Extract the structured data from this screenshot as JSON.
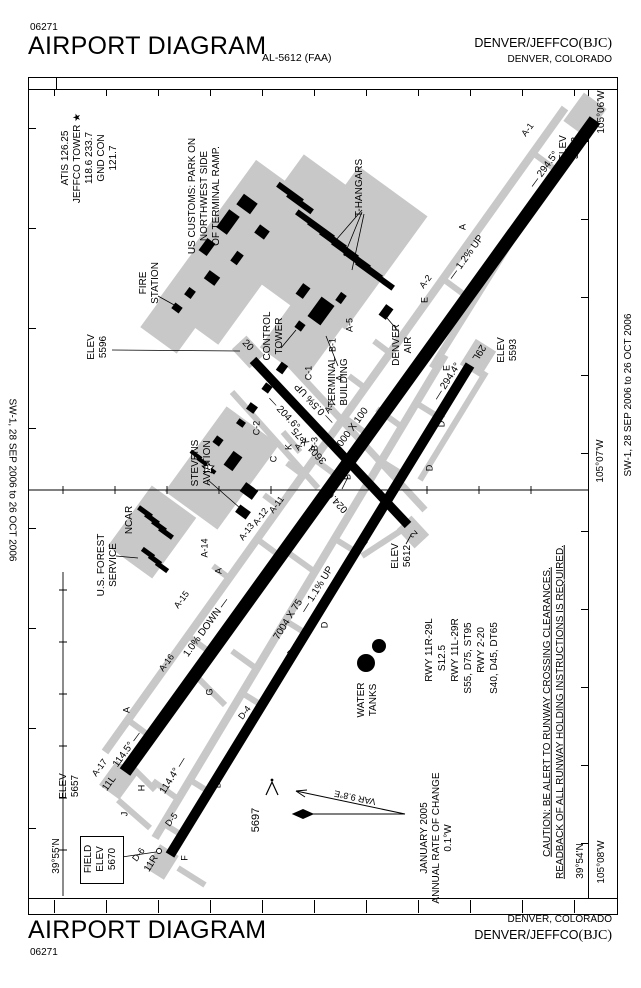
{
  "header": {
    "code": "06271",
    "title": "AIRPORT DIAGRAM",
    "al": "AL-5612 (FAA)",
    "name": "DENVER/JEFFCO",
    "icao": "(BJC)",
    "city": "DENVER, COLORADO"
  },
  "footer": {
    "title": "AIRPORT DIAGRAM",
    "code": "06271",
    "city": "DENVER, COLORADO",
    "name": "DENVER/JEFFCO",
    "icao": "(BJC)"
  },
  "edition": {
    "left": "SW-1, 28 SEP 2006 to 26 OCT 2006",
    "right": "SW-1, 28 SEP 2006 to 26 OCT 2006"
  },
  "grid": {
    "lon_top": "105°06'W",
    "lon_mid": "105°07'W",
    "lon_bot": "105°08'W",
    "lat_left": "39°55'N",
    "lat_right": "39°54'N"
  },
  "comm": [
    "ATIS 126.25",
    "JEFFCO TOWER ★",
    "118.6 233.7",
    "GND CON",
    "121.7"
  ],
  "notes": {
    "customs": [
      "US CUSTOMS: PARK ON",
      "NORTHWEST SIDE",
      "OF TERMINAL RAMP."
    ],
    "caution": [
      "CAUTION: BE ALERT TO RUNWAY CROSSING CLEARANCES.",
      "READBACK OF ALL RUNWAY HOLDING INSTRUCTIONS IS REQUIRED."
    ]
  },
  "variation": {
    "var": "VAR 9.8°E",
    "note": [
      "JANUARY 2005",
      "ANNUAL RATE OF CHANGE",
      "0.1°W"
    ]
  },
  "rwy_data": [
    "RWY 11R-29L",
    "S12.5",
    "RWY 11L-29R",
    "S55, D75, ST95",
    "RWY 2-20",
    "S40, D45, DT65"
  ],
  "field_elev": [
    "FIELD",
    "ELEV",
    "5670"
  ],
  "obstruction": "5697",
  "fac": {
    "thangars": "T-HANGARS",
    "fire": [
      "FIRE",
      "STATION"
    ],
    "tower": [
      "CONTROL",
      "TOWER"
    ],
    "terminal": [
      "TERMINAL",
      "BUILDING"
    ],
    "denverair": [
      "DENVER",
      "AIR"
    ],
    "stevens": [
      "STEVENS",
      "AVIATION"
    ],
    "ncar": "NCAR",
    "usfs": [
      "U.S. FOREST",
      "SERVICE"
    ],
    "water": [
      "WATER",
      "TANKS"
    ]
  },
  "rwy": {
    "main": {
      "n1": "11L",
      "n2": "29R",
      "dim": "9000 X 100",
      "h1": "114.5° —",
      "h2": "— 294.5°",
      "g1": "— 1.2% UP",
      "g2": "1.0% DOWN —",
      "e1": [
        "ELEV",
        "5657"
      ],
      "e2": [
        "ELEV",
        "5562"
      ]
    },
    "par": {
      "n1": "11R",
      "n2": "29L",
      "dim": "7004 X 75",
      "h1": "114.4° —",
      "h2": "— 294.4°",
      "g1": "— 1.1% UP",
      "e2": [
        "ELEV",
        "5593"
      ]
    },
    "cross": {
      "n1": "2",
      "n2": "20",
      "dim": "3601 X 75",
      "h1": "024.6°",
      "h2": "— 204.6°",
      "g1": "— 0.5% UP",
      "e1": [
        "ELEV",
        "5612"
      ],
      "e2": [
        "ELEV",
        "5596"
      ]
    }
  },
  "twy": [
    "A-1",
    "A",
    "A-2",
    "E",
    "A-5",
    "E",
    "A",
    "A-7",
    "A-8",
    "A-11",
    "A-12",
    "A-13",
    "A-14",
    "A",
    "A-15",
    "A-16",
    "A",
    "A-17",
    "B-1",
    "C-1",
    "C",
    "C-2",
    "K",
    "C",
    "B",
    "B-3",
    "D-1",
    "D",
    "D-2",
    "D",
    "D-3",
    "D-4",
    "G",
    "D",
    "D-5",
    "H",
    "J",
    "D-6",
    "F"
  ]
}
